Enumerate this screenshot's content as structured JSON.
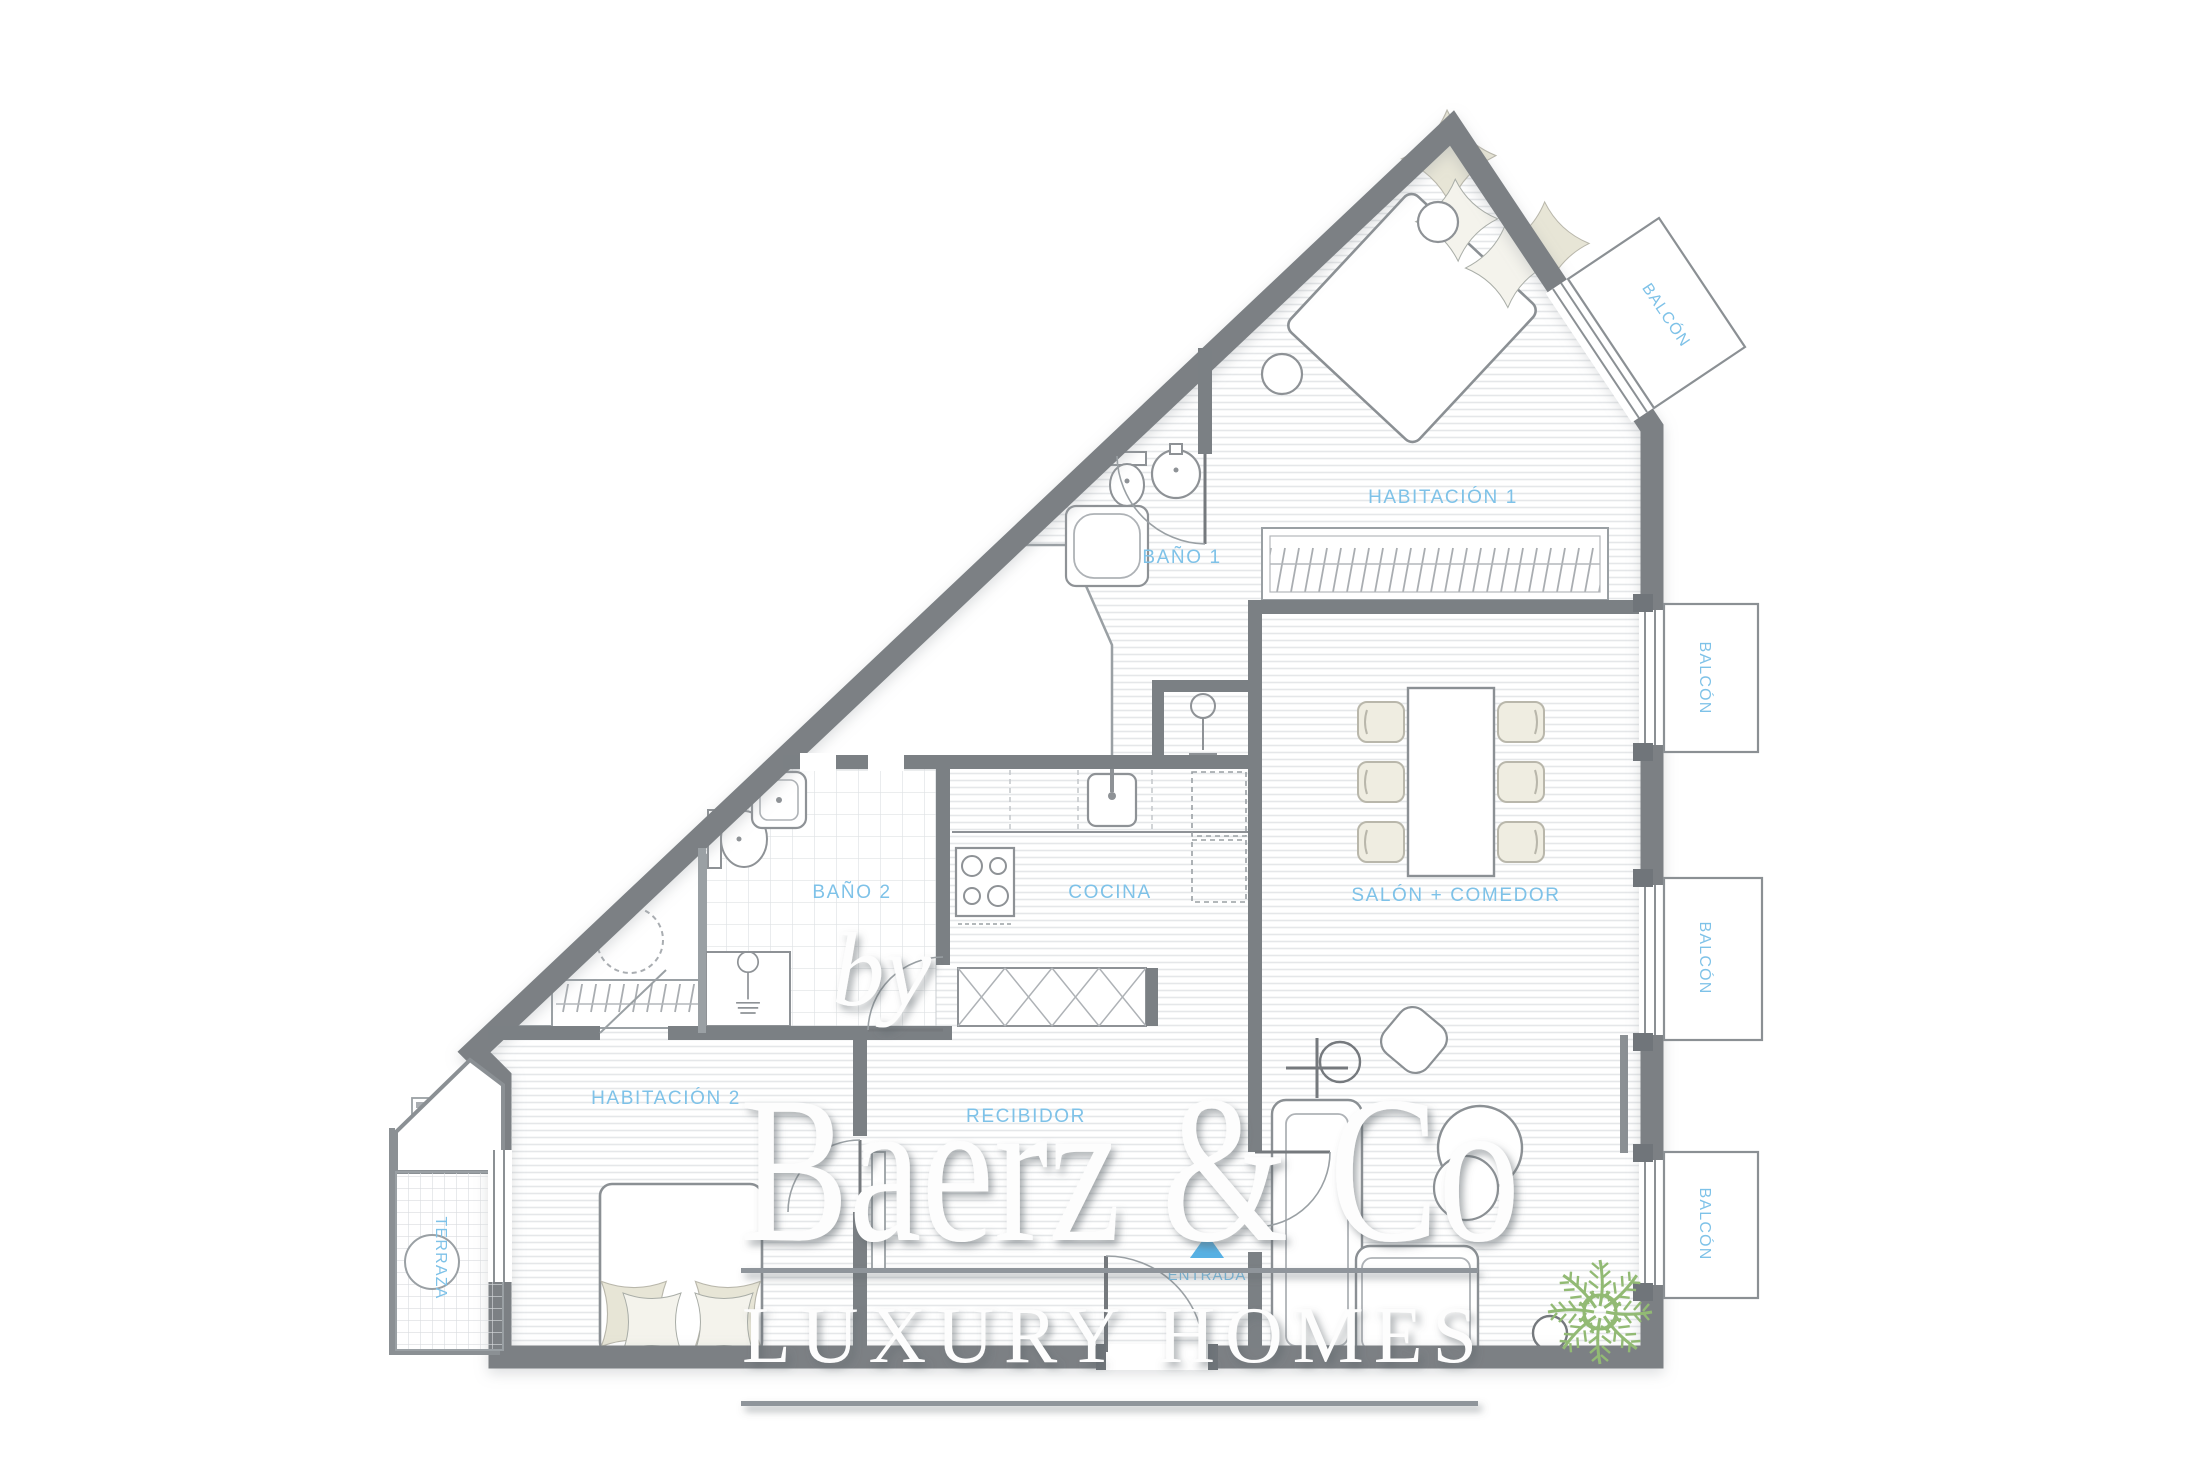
{
  "watermark": {
    "prefix": "by",
    "brand": "Baerz & Co",
    "tagline": "LUXURY HOMES"
  },
  "plan": {
    "rooms": [
      {
        "id": "habitacion-1",
        "label": "HABITACIÓN 1"
      },
      {
        "id": "bano-1",
        "label": "BAÑO 1"
      },
      {
        "id": "cocina",
        "label": "COCINA"
      },
      {
        "id": "salon-comedor",
        "label": "SALÓN + COMEDOR"
      },
      {
        "id": "bano-2",
        "label": "BAÑO 2"
      },
      {
        "id": "habitacion-2",
        "label": "HABITACIÓN 2"
      },
      {
        "id": "recibidor",
        "label": "RECIBIDOR"
      },
      {
        "id": "terraza",
        "label": "TERRAZA"
      }
    ],
    "balconies": [
      {
        "label": "BALCÓN"
      },
      {
        "label": "BALCÓN"
      },
      {
        "label": "BALCÓN"
      },
      {
        "label": "BALCÓN"
      }
    ],
    "entrance": {
      "label": "ENTRADA"
    }
  },
  "colors": {
    "label_blue": "#7ec2e8",
    "wall_gray": "#7b8084",
    "furniture_gray": "#8e9296",
    "pillow_beige": "#eae8da",
    "plant_green": "#92ba74",
    "entrance_blue": "#57b1e4",
    "watermark_white": "#fdfdfd"
  }
}
